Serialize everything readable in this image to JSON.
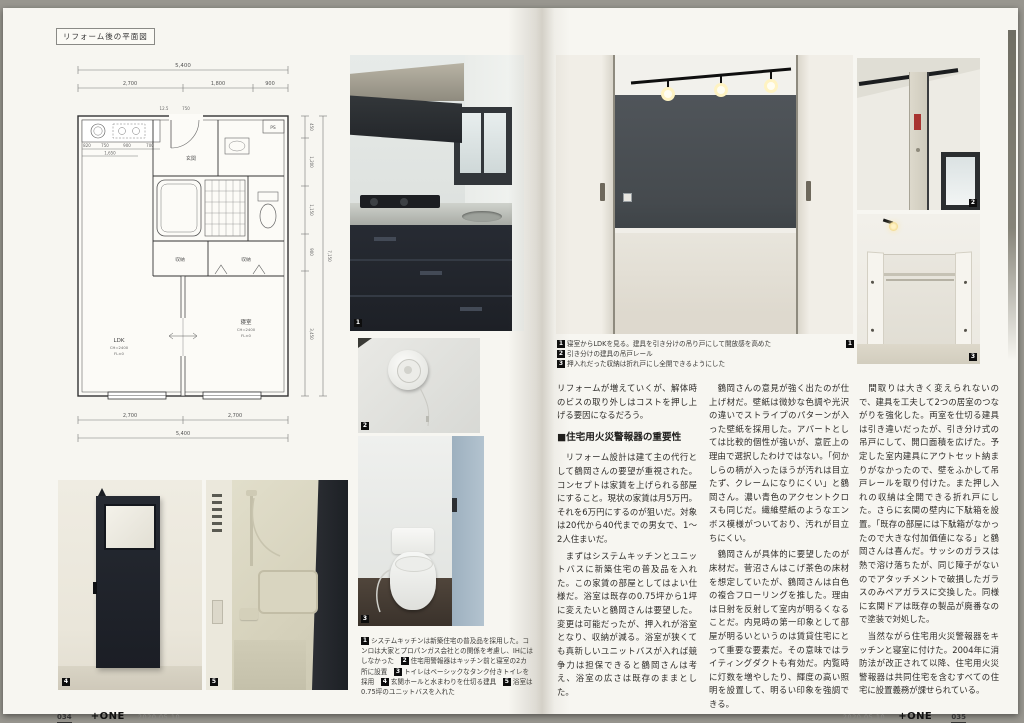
{
  "meta": {
    "brand": "+ONE",
    "date": "2020.05.10",
    "page_left": "034",
    "page_right": "035"
  },
  "plan": {
    "label": "リフォーム後の平面図",
    "dims": {
      "top_total": "5,400",
      "t1": "2,700",
      "t2": "1,800",
      "t3": "900",
      "b1": "2,700",
      "b2": "2,700",
      "bottom_total": "5,400",
      "r1": "450",
      "r2": "1,200",
      "r3": "1,150",
      "r4": "900",
      "r5": "3,450",
      "right_total": "7,150",
      "k0": "820",
      "k1": "750",
      "k2": "900",
      "k3": "700",
      "k_total": "1,650",
      "e1": "12.5",
      "e2": "750"
    },
    "rooms": {
      "ldk": "LDK",
      "ldk_ch": "CH=2400",
      "ldk_fl": "FL±0",
      "bed": "寝室",
      "bed_ch": "CH=2400",
      "bed_fl": "FL±0",
      "ps": "PS",
      "genkan": "玄関",
      "closet1": "収納",
      "closet2": "収納"
    }
  },
  "markers": {
    "m1": "1",
    "m2": "2",
    "m3": "3",
    "m4": "4",
    "m5": "5"
  },
  "left_captions": [
    {
      "num": "1",
      "text": "システムキッチンは新築住宅の普及品を採用した。コンロは大家とプロパンガス会社との関係を考慮し、IHにはしなかった　"
    },
    {
      "num": "2",
      "text": "住宅用警報器はキッチン前と寝室の2カ所に設置　"
    },
    {
      "num": "3",
      "text": "トイレはベーシックなタンク付きトイレを採用　"
    },
    {
      "num": "4",
      "text": "玄関ホールと水まわりを仕切る建具　"
    },
    {
      "num": "5",
      "text": "浴室は0.75坪のユニットバスを入れた"
    }
  ],
  "right_captions": [
    {
      "num": "1",
      "text": "寝室からLDKを見る。建具を引き分けの吊り戸にして開放感を高めた"
    },
    {
      "num": "2",
      "text": "引き分けの建具の吊戸レール"
    },
    {
      "num": "3",
      "text": "押入れだった収納は折れ戸にし全開できるようにした"
    }
  ],
  "article": {
    "p0": "リフォームが増えていくが、解体時のビスの取り外しはコストを押し上げる要因になるだろう。",
    "heading": "■住宅用火災警報器の重要性",
    "p1": "　リフォーム設計は建て主の代行として鶴岡さんの要望が重視された。コンセプトは家賃を上げられる部屋にすること。現状の家賃は月5万円。それを6万円にするのが狙いだ。対象は20代から40代までの男女で、1〜2人住まいだ。",
    "p2": "　まずはシステムキッチンとユニットバスに新築住宅の普及品を入れた。この家賃の部屋としてはよい仕様だ。浴室は既存の0.75坪から1坪に変えたいと鶴岡さんは要望した。変更は可能だったが、押入れが浴室となり、収納が減る。浴室が狭くても真新しいユニットバスが入れば競争力は担保できると鶴岡さんは考え、浴室の広さは既存のままとした。",
    "c2p1": "　鶴岡さんの意見が強く出たのが仕上げ材だ。壁紙は微妙な色調や光沢の違いでストライプのパターンが入った壁紙を採用した。アパートとしては比較的個性が強いが、意匠上の理由で選択したわけではない。「何かしらの柄が入ったほうが汚れは目立たず、クレームになりにくい」と鶴岡さん。濃い青色のアクセントクロスも同じだ。繊維壁紙のようなエンボス模様がついており、汚れが目立ちにくい。",
    "c2p2": "　鶴岡さんが具体的に要望したのが床材だ。菅沼さんはこげ茶色の床材を想定していたが、鶴岡さんは白色の複合フローリングを推した。理由は日射を反射して室内が明るくなることだ。内見時の第一印象として部屋が明るいというのは賃貸住宅にとって重要な要素だ。その意味ではライティングダクトも有効だ。内覧時に灯数を増やしたり、輝度の高い照明を設置して、明るい印象を強調できる。",
    "c3p1": "　間取りは大きく変えられないので、建具を工夫して2つの居室のつながりを強化した。両室を仕切る建具は引き違いだったが、引き分け式の吊戸にして、開口面積を広げた。予定した室内建具にアウトセット納まりがなかったので、壁をふかして吊戸レールを取り付けた。また押し入れの収納は全開できる折れ戸にした。さらに玄関の壁内に下駄箱を設置。「既存の部屋には下駄箱がなかったので大きな付加価値になる」と鶴岡さんは喜んだ。サッシのガラスは熱で溶け落ちたが、同じ障子がないのでアタッチメントで破損したガラスのみペアガラスに交換した。同様に玄関ドアは既存の製品が廃番なので塗装で対処した。",
    "c3p2": "　当然ながら住宅用火災警報器をキッチンと寝室に付けた。2004年に消防法が改正されて以降、住宅用火災警報器は共同住宅を含むすべての住宅に設置義務が課せられている。"
  },
  "colors": {
    "accent_wall": "#4d5256",
    "cabinet_navy": "#23262e",
    "page_bg": "#f7f6f1"
  }
}
